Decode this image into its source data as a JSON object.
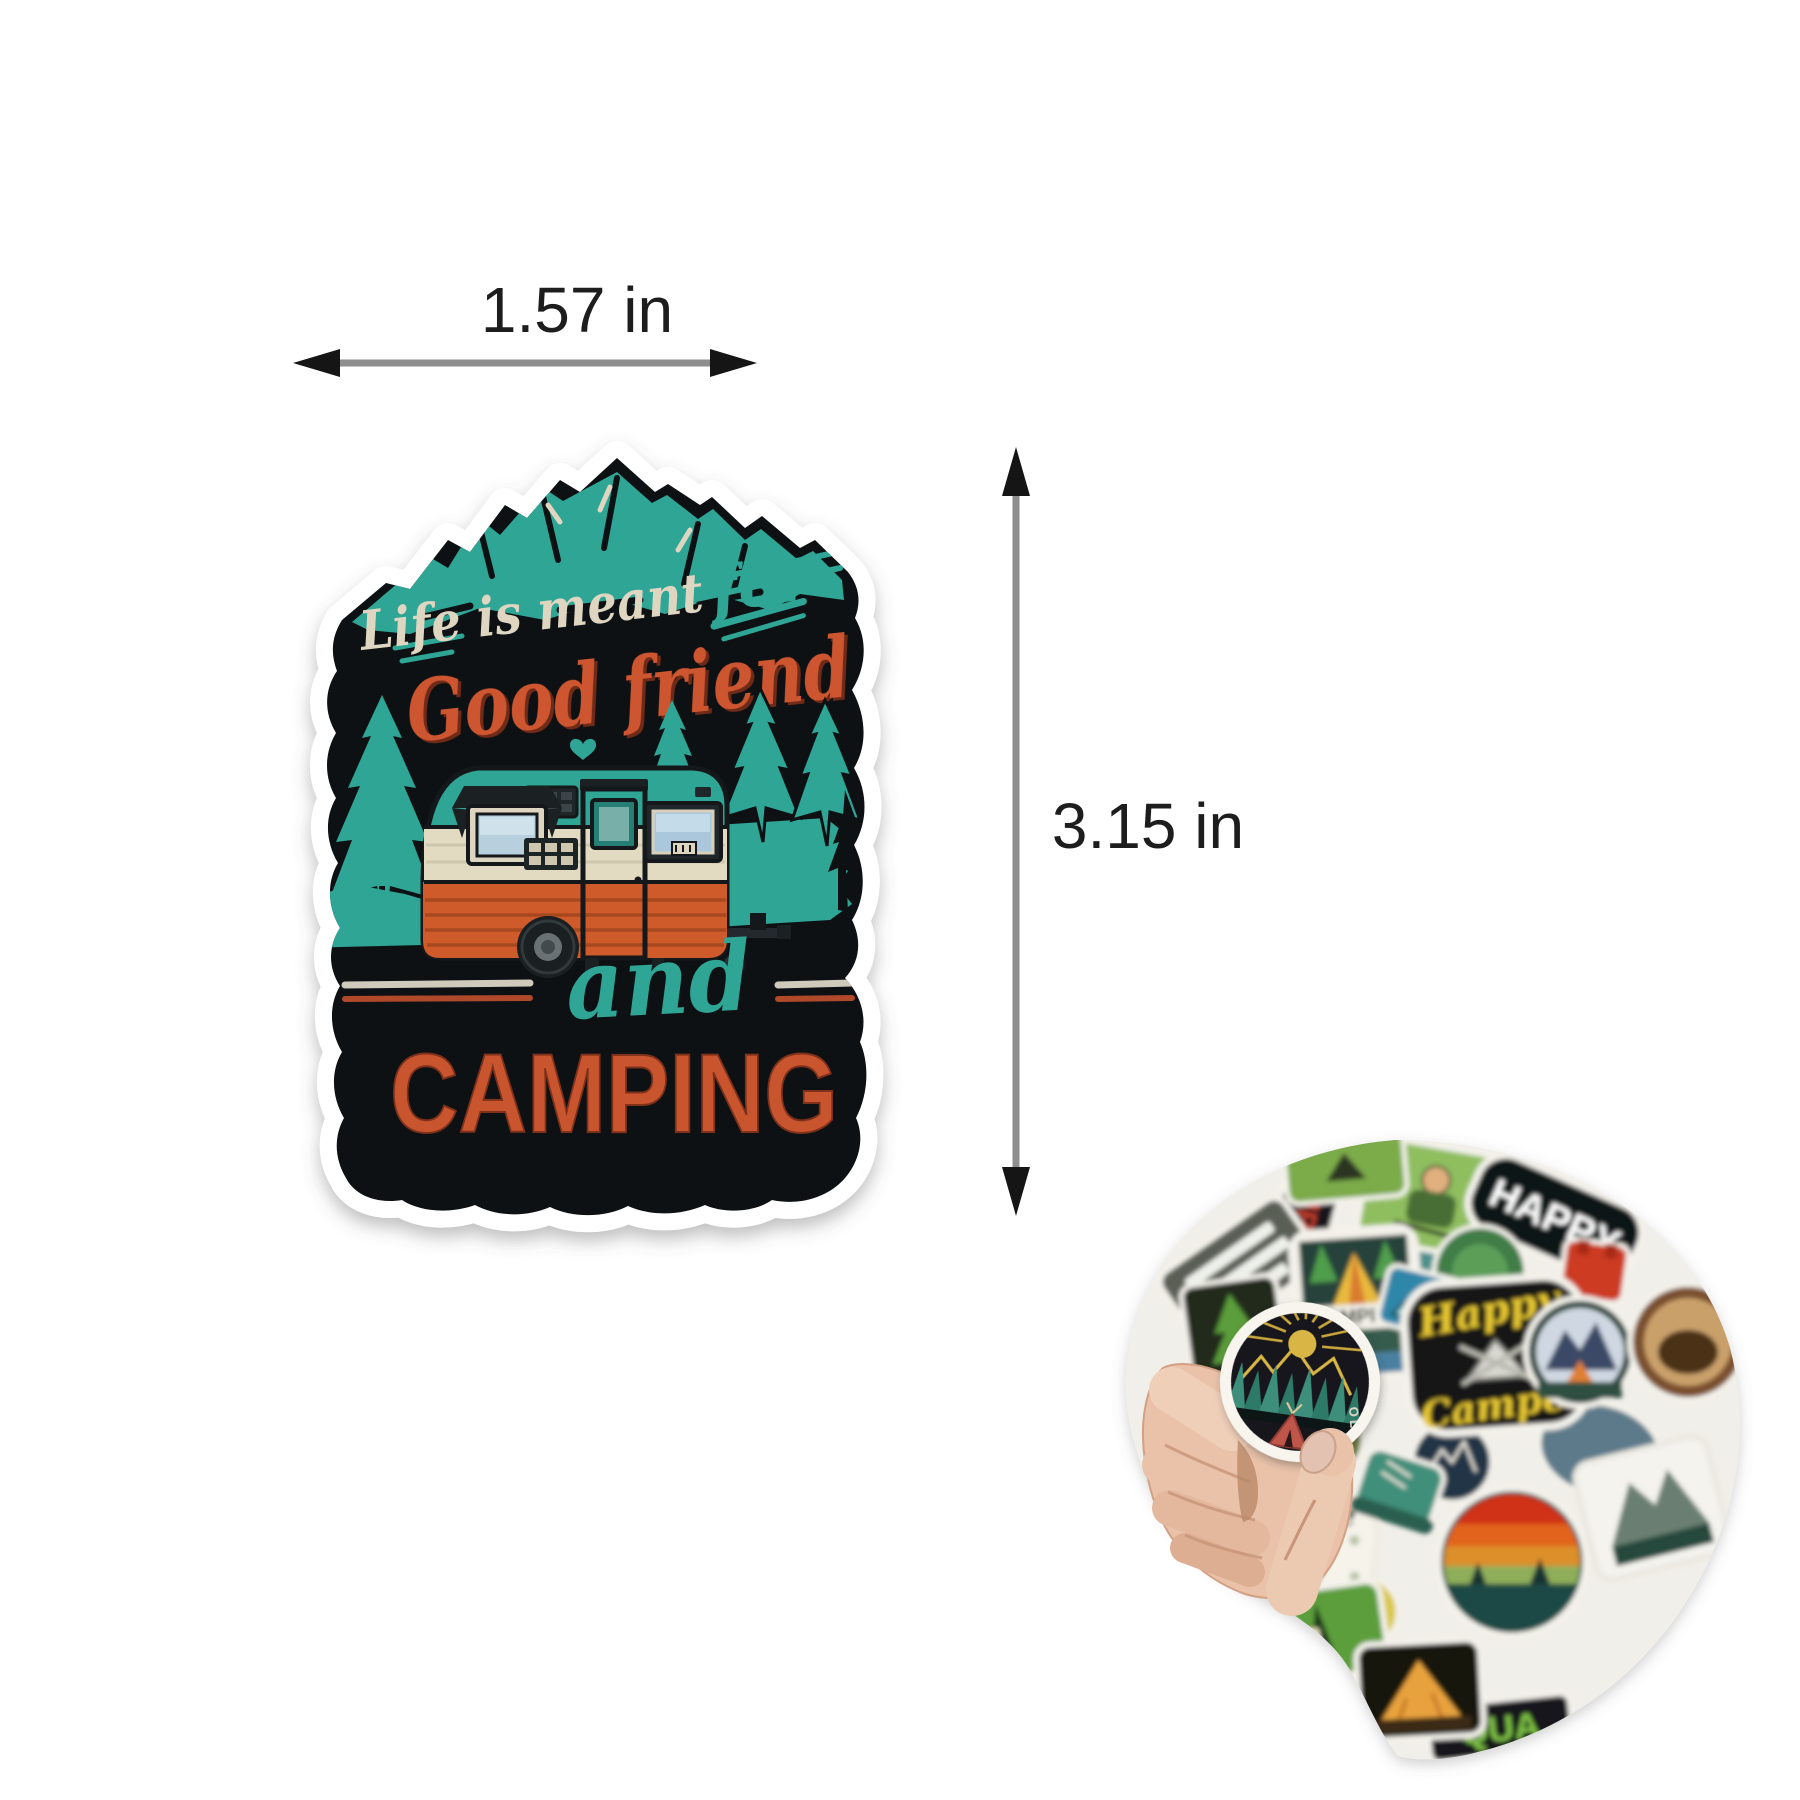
{
  "annotations": {
    "width_label": "1.57 in",
    "height_label": "3.15 in",
    "arrow_shaft_color": "#8e8e8e",
    "arrowhead_color": "#151515",
    "label_color": "#1d1d1d"
  },
  "main_sticker": {
    "text": {
      "line1": "Life is meant",
      "line1_accent": "for",
      "line2": "Good friend",
      "conjunction": "and",
      "line3": "CAMPING"
    },
    "colors": {
      "background": "#0d1113",
      "border": "#ffffff",
      "teal": "#2fa596",
      "cream_text": "#ded6c1",
      "orange_script": "#cd5630",
      "orange_caps": "#c8552d",
      "camper_teal": "#2fa596",
      "camper_cream": "#e3dac2",
      "camper_orange": "#cf5a2a",
      "rule_silver": "#cfcabc",
      "rule_red": "#b0482a"
    },
    "artwork": [
      "mountain-range-icon",
      "pine-tree-icon",
      "camper-trailer-icon",
      "heart-icon"
    ]
  },
  "pile": {
    "held_sticker": {
      "edge_text": "OLE",
      "artwork": [
        "sun-icon",
        "gold-mountains-icon",
        "pine-row-icon",
        "tent-icon"
      ],
      "colors": {
        "face": "#15191a",
        "gold": "#d9b545",
        "pine": "#3d8f7c",
        "tent": "#c05648"
      }
    },
    "texts": {
      "camping_red": "CAMPING",
      "camping_badge": "CAMPING",
      "happy": "HAPPY",
      "happy_camper_line1": "Happy",
      "happy_camper_line2": "Camper",
      "explore": "Explore",
      "world": "world",
      "quality_partial": "QUA"
    },
    "hand_skin_color": "#e9c2a9"
  }
}
